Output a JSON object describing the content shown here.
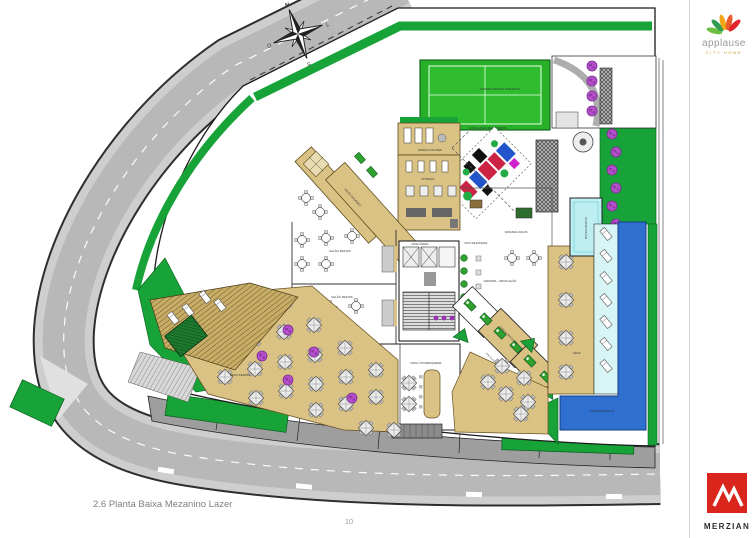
{
  "page": {
    "caption": "2.6 Planta Baixa Mezanino Lazer",
    "page_number": "10"
  },
  "branding": {
    "applause": {
      "name": "applause",
      "tagline": "CITY HOME"
    },
    "merzian": {
      "name": "MERZIAN"
    }
  },
  "compass": {
    "north": "N",
    "east": "L",
    "south": "S",
    "west": "O"
  },
  "rooms": {
    "quadra": "QUADRA GRAMA SINTÉTICA",
    "circulacao_descoberta": "CIRCULAÇÃO DESCOBERTA",
    "espaco_pilates": "ESPAÇO PILATES",
    "fitness": "FITNESS",
    "salao_gourmet": "SALÃO GOURMET",
    "salao_festas": "SALÃO FESTAS",
    "deck_festas": "DECK FESTAS",
    "varanda_jogos": "VARANDA JOGOS",
    "varanda_circulacao": "VARANDA - CIRCULAÇÃO",
    "ante_camara": "ANTE-CÂMARA",
    "duto_entrada": "DUTO DE ENTRADA",
    "circulacao": "CIRCULAÇÃO",
    "circulacao_sauna": "CIRCULAÇÃO SAUNA",
    "espaco_massagem": "ESPAÇO MASSAGEM",
    "cozinha": "COZINHA",
    "pizza_churrasqueira": "PIZZA / CHURRASQUEIRA",
    "deck": "DECK",
    "piscina_infantil": "PISCINA INFANTIL",
    "piscina_adulto": "PISCINA ADULTO"
  },
  "colors": {
    "road_gray": "#c0c0c0",
    "landscape_green": "#18a339",
    "court_green": "#2fbd2f",
    "deck_tan": "#d9c283",
    "pool_blue": "#2e6fd0",
    "kids_pool_cyan": "#bdeef2",
    "tree_purple": "#b44fc8",
    "brand_red": "#d9251c"
  }
}
